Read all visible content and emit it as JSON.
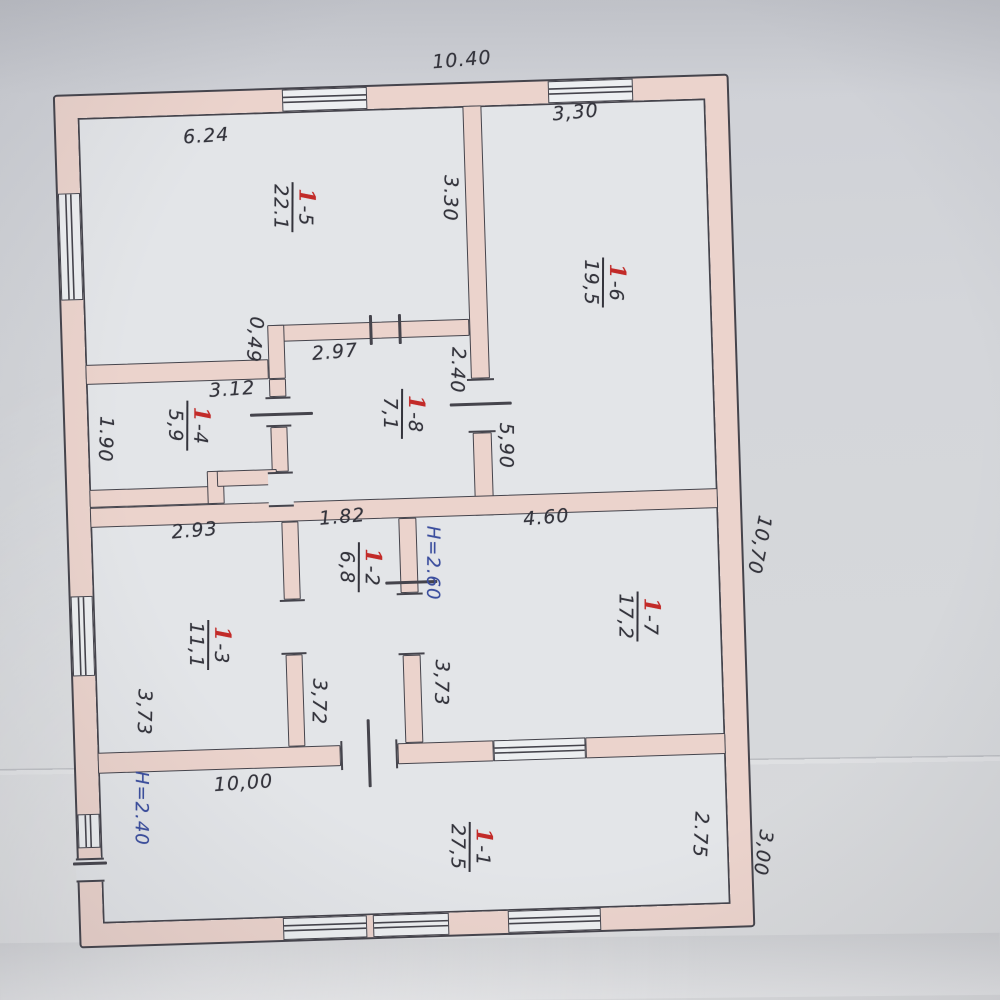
{
  "colors": {
    "paper": "#d4d6da",
    "interior": "#e3e5e8",
    "wall": "#ebd3cc",
    "line": "#45444c",
    "winbg": "#edeff1",
    "ink": "#34343c",
    "red": "#c22a28",
    "blue": "#3b4e9e"
  },
  "overall_dimensions": {
    "top_width": "10.40",
    "right_height": "10,70",
    "bottom_right_height": "3,00"
  },
  "labels": {
    "dimensions": [
      {
        "text": "10.40",
        "x": 408,
        "y": -16,
        "r": -3
      },
      {
        "text": "6.24",
        "x": 150,
        "y": 52,
        "r": -2
      },
      {
        "text": "3,30",
        "x": 520,
        "y": 40,
        "r": -3
      },
      {
        "text": "3.30",
        "x": 392,
        "y": 122,
        "r": 93
      },
      {
        "text": "0,49",
        "x": 192,
        "y": 257,
        "r": 97
      },
      {
        "text": "2.97",
        "x": 272,
        "y": 272,
        "r": -3
      },
      {
        "text": "3.12",
        "x": 168,
        "y": 306,
        "r": -2
      },
      {
        "text": "1.90",
        "x": 40,
        "y": 352,
        "r": 94
      },
      {
        "text": "2.40",
        "x": 394,
        "y": 294,
        "r": 94
      },
      {
        "text": "5,90",
        "x": 440,
        "y": 371,
        "r": 92
      },
      {
        "text": "2.93",
        "x": 126,
        "y": 446,
        "r": -3
      },
      {
        "text": "1.82",
        "x": 274,
        "y": 437,
        "r": -3
      },
      {
        "text": "4.60",
        "x": 478,
        "y": 444,
        "r": -3
      },
      {
        "text": "3,73",
        "x": 70,
        "y": 626,
        "r": 93
      },
      {
        "text": "3,72",
        "x": 245,
        "y": 621,
        "r": 93
      },
      {
        "text": "3,73",
        "x": 368,
        "y": 606,
        "r": 93
      },
      {
        "text": "10,00",
        "x": 167,
        "y": 700,
        "r": -2
      },
      {
        "text": "2.75",
        "x": 622,
        "y": 766,
        "r": 95
      },
      {
        "text": "3,00",
        "x": 684,
        "y": 786,
        "r": 100
      },
      {
        "text": "10,70",
        "x": 690,
        "y": 478,
        "r": 103
      }
    ],
    "heights": [
      {
        "text": "H=2.60",
        "x": 363,
        "y": 486,
        "r": 92
      },
      {
        "text": "H=2.40",
        "x": 64,
        "y": 722,
        "r": 92
      }
    ],
    "rooms": [
      {
        "prefix": "1",
        "rest": "-5",
        "area": "22.1",
        "x": 235,
        "y": 126,
        "r": 92
      },
      {
        "prefix": "1",
        "rest": "-6",
        "area": "19,5",
        "x": 543,
        "y": 211,
        "r": 92
      },
      {
        "prefix": "1",
        "rest": "-4",
        "area": "5,9",
        "x": 123,
        "y": 341,
        "r": 92
      },
      {
        "prefix": "1",
        "rest": "-8",
        "area": "7,1",
        "x": 338,
        "y": 336,
        "r": 92
      },
      {
        "prefix": "1",
        "rest": "-3",
        "area": "11,1",
        "x": 137,
        "y": 561,
        "r": 92
      },
      {
        "prefix": "1",
        "rest": "-2",
        "area": "6,8",
        "x": 290,
        "y": 488,
        "r": 92
      },
      {
        "prefix": "1",
        "rest": "-7",
        "area": "17,2",
        "x": 567,
        "y": 546,
        "r": 92
      },
      {
        "prefix": "1",
        "rest": "-1",
        "area": "27,5",
        "x": 392,
        "y": 771,
        "r": 92
      }
    ]
  }
}
